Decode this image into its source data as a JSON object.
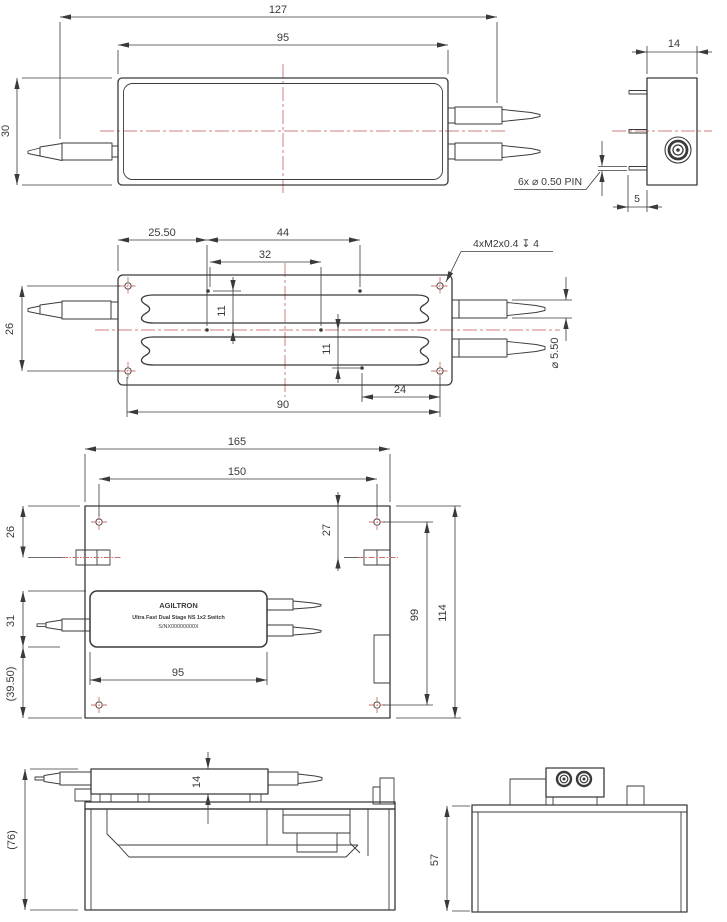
{
  "drawing": {
    "title": "Fiber optic switch mechanical drawing",
    "colors": {
      "line": "#3a3a3a",
      "centerline": "#cf7f7c",
      "background": "#ffffff"
    },
    "v1": {
      "d127": "127",
      "d95": "95",
      "d30": "30",
      "d14": "14",
      "d5": "5",
      "pin_note": "6x ⌀ 0.50 PIN"
    },
    "v2": {
      "d2550": "25.50",
      "d44": "44",
      "d32": "32",
      "d11a": "11",
      "d11b": "11",
      "d26": "26",
      "d90": "90",
      "d24": "24",
      "d550": "⌀ 5.50",
      "thread_note": "4xM2x0.4 ↧ 4"
    },
    "v3": {
      "d165": "165",
      "d150": "150",
      "d26": "26",
      "d27": "27",
      "d31": "31",
      "d3950": "(39.50)",
      "d95": "95",
      "d99": "99",
      "d114": "114",
      "label_brand": "AGILTRON",
      "label_product": "Ultra Fast Dual Stage NS 1x2 Switch",
      "label_serial": "S/NX00000000X"
    },
    "v4": {
      "d14": "14",
      "d76": "(76)"
    },
    "v5": {
      "d57": "57"
    }
  }
}
